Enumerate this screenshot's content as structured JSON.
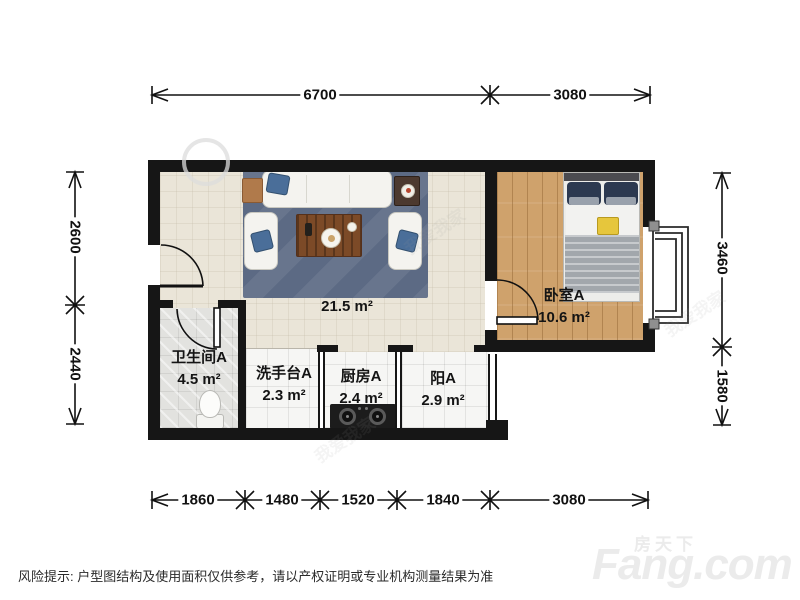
{
  "rooms": {
    "living": {
      "name": "",
      "area": "21.5 m²"
    },
    "bedroom": {
      "name": "卧室A",
      "area": "10.6 m²"
    },
    "bathroom": {
      "name": "卫生间A",
      "area": "4.5 m²"
    },
    "washstand": {
      "name": "洗手台A",
      "area": "2.3 m²"
    },
    "kitchen": {
      "name": "厨房A",
      "area": "2.4 m²"
    },
    "balcony": {
      "name": "阳A",
      "area": "2.9 m²"
    }
  },
  "dimensions": {
    "top": {
      "seg1": "6700",
      "seg2": "3080"
    },
    "bottom": {
      "seg1": "1860",
      "seg2": "1480",
      "seg3": "1520",
      "seg4": "1840",
      "seg5": "3080"
    },
    "left": {
      "seg1": "2600",
      "seg2": "2440"
    },
    "right": {
      "seg1": "3460",
      "seg2": "1580"
    }
  },
  "footer": {
    "disclaimer": "风险提示: 户型图结构及使用面积仅供参考，请以产权证明或专业机构测量结果为准"
  },
  "branding": {
    "portal_logo": "Fang.com",
    "portal_name": "房天下",
    "agency_watermark": "我爱我家"
  },
  "colors": {
    "wall": "#161616",
    "living_floor": "#eae5d8",
    "bedroom_floor": "#cfa26c",
    "rug": "#5c6a84",
    "dimension_line": "#111111"
  }
}
